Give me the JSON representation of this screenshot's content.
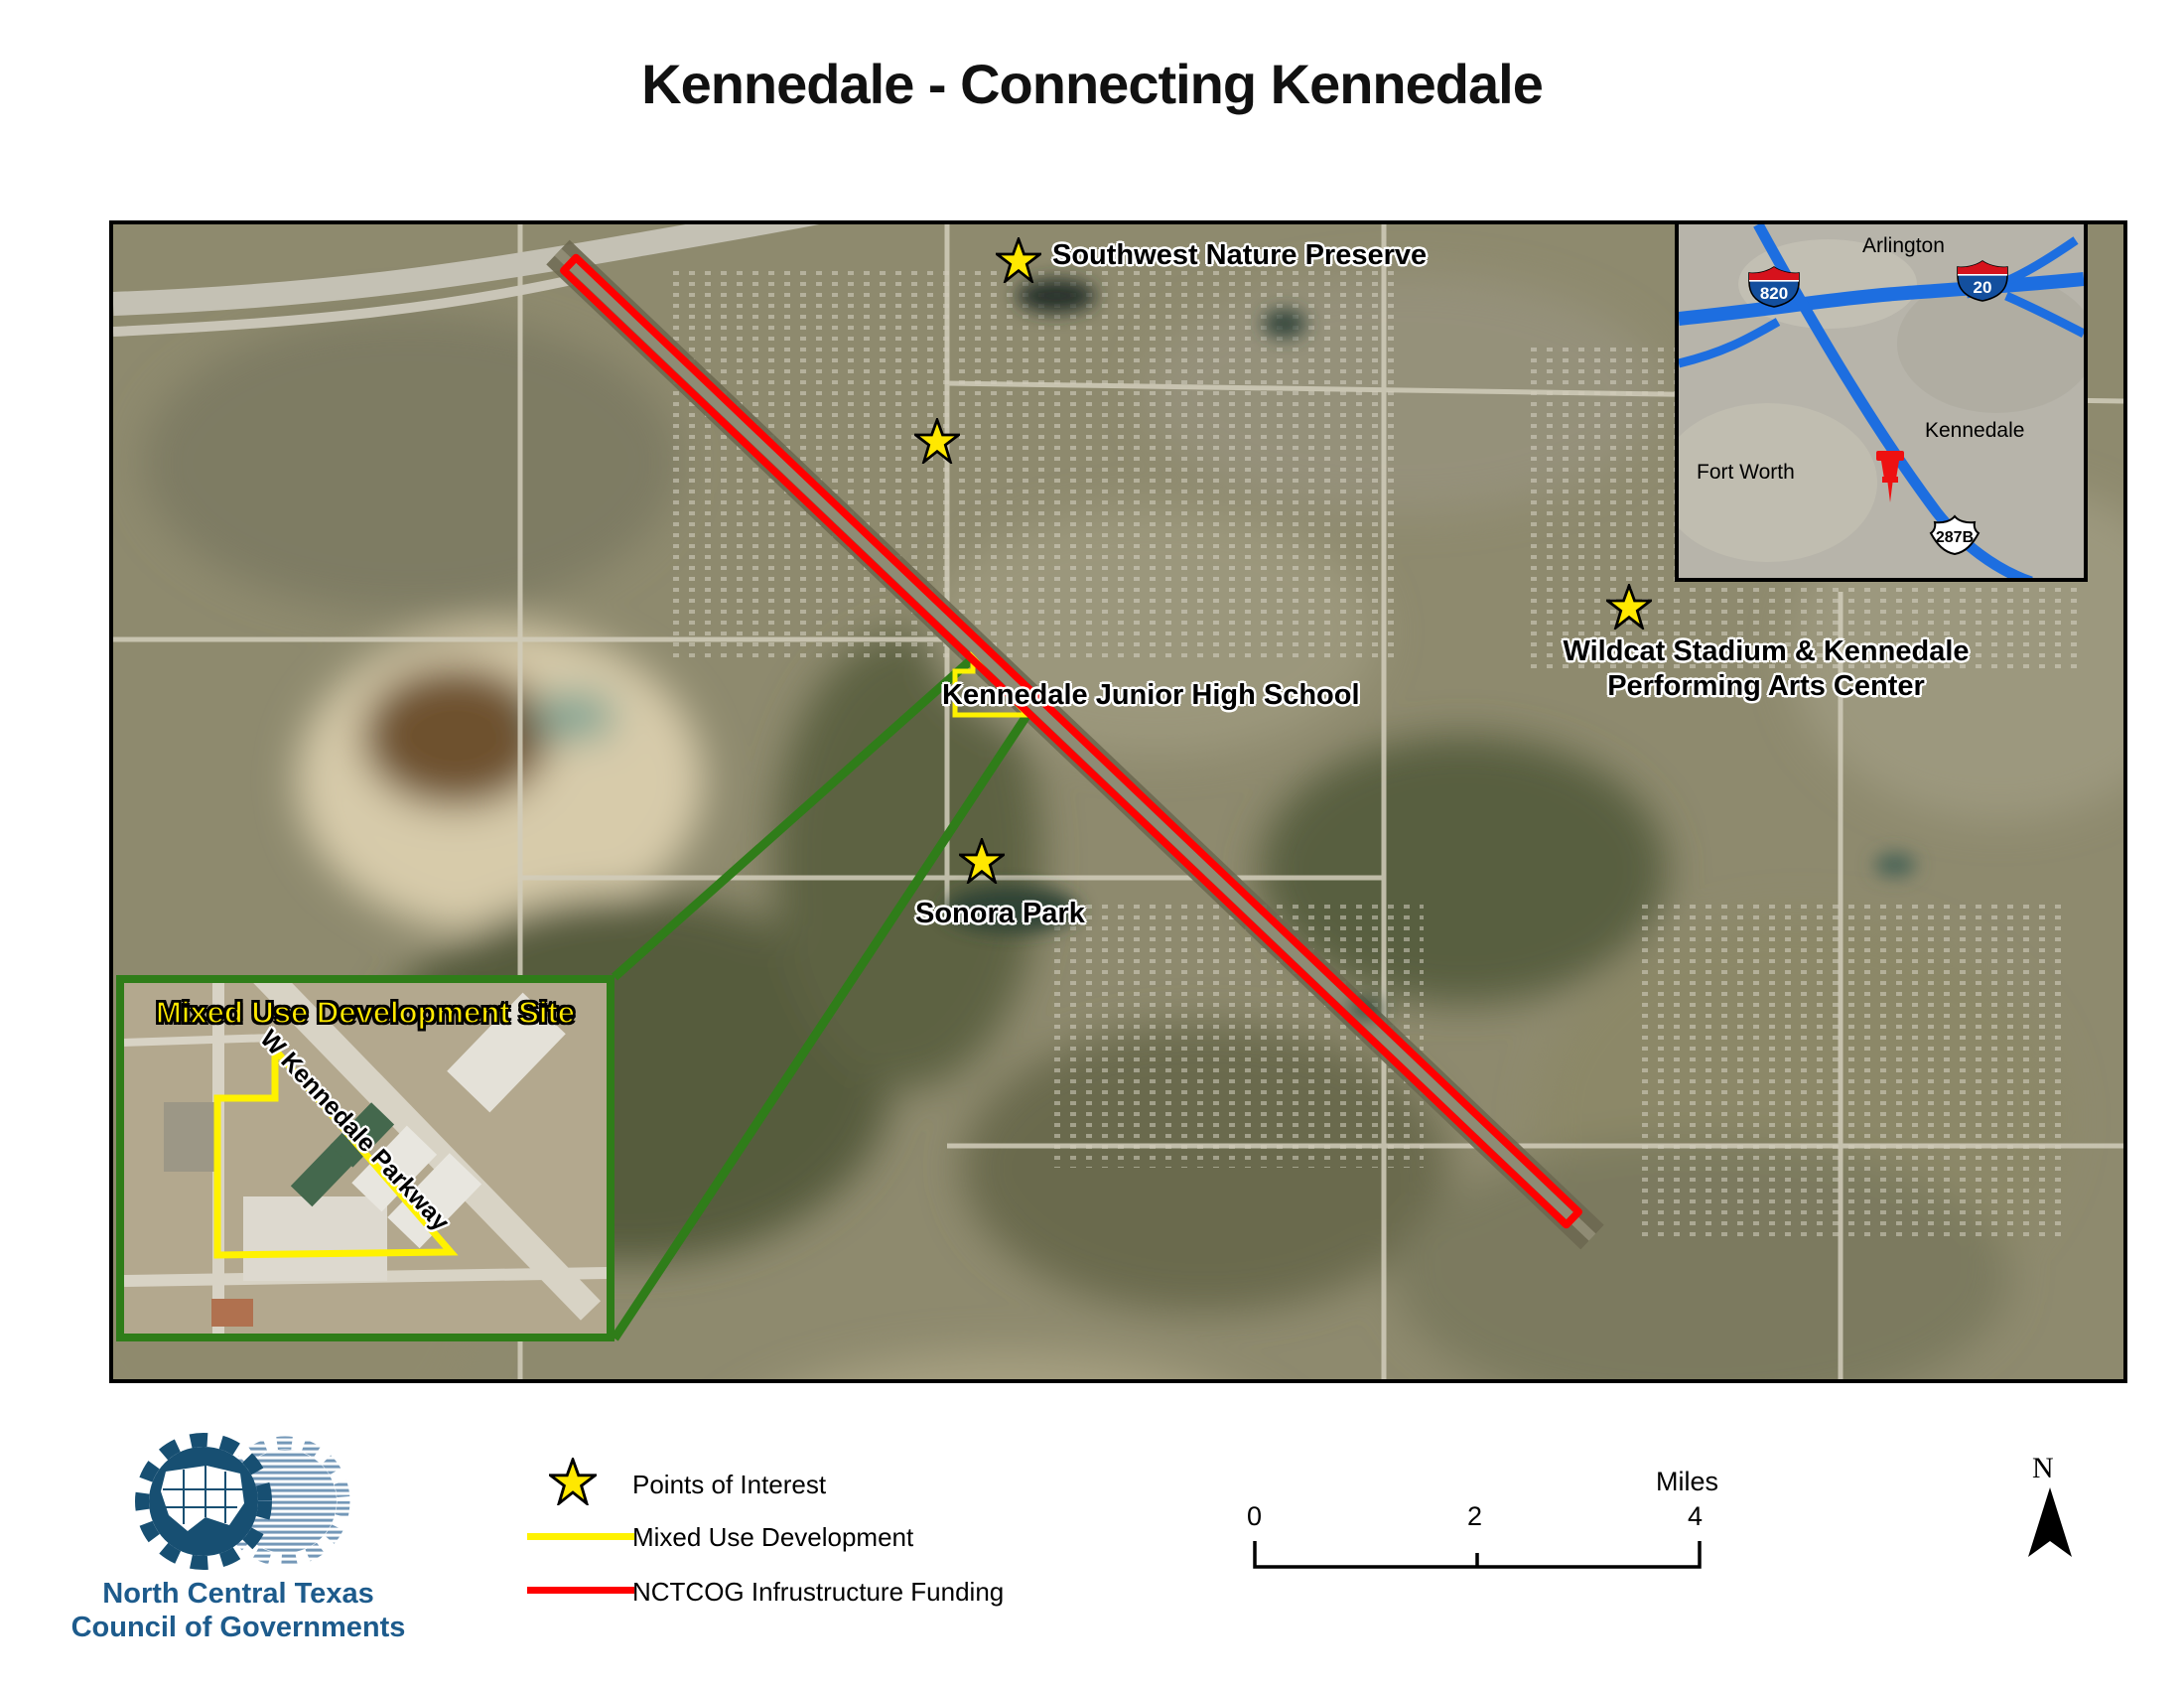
{
  "title": "Kennedale - Connecting Kennedale",
  "map": {
    "pois": [
      {
        "label": "Southwest Nature Preserve"
      },
      {
        "label": "Kennedale Junior High School"
      },
      {
        "line1": "Wildcat Stadium & Kennedale",
        "line2": "Performing Arts Center"
      },
      {
        "label": "Sonora Park"
      }
    ],
    "site_inset": {
      "title": "Mixed Use Development Site",
      "road": "W Kennedale Parkway"
    },
    "locator": {
      "arlington": "Arlington",
      "fort_worth": "Fort Worth",
      "kennedale": "Kennedale",
      "shield_820": "820",
      "shield_20": "20",
      "shield_287b": "287B"
    }
  },
  "legend": {
    "poi": "Points of Interest",
    "mixed_use": "Mixed Use Development",
    "funding": "NCTCOG Infrustructure Funding"
  },
  "scalebar": {
    "t0": "0",
    "t1": "2",
    "t2": "4",
    "unit": "Miles"
  },
  "north": {
    "label": "N"
  },
  "logo": {
    "line1": "North Central Texas",
    "line2": "Council of Governments"
  },
  "colors": {
    "funding_red": "#FF0000",
    "mixed_use_yellow": "#FFF200",
    "callout_green": "#2F7D19",
    "highway_blue": "#1D6EE0",
    "logo_blue": "#1D5B8C"
  }
}
